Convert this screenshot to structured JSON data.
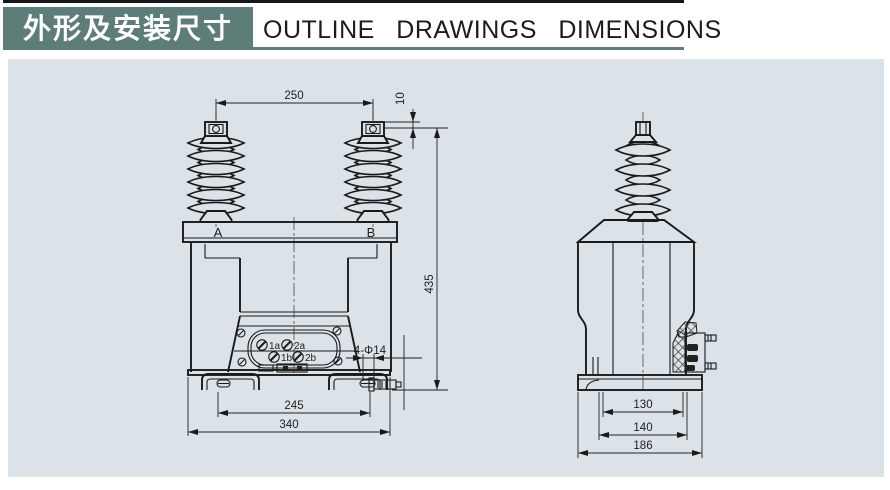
{
  "header": {
    "title_cn": "外形及安装尺寸",
    "title_en": "OUTLINE DRAWINGS DIMENSIONS"
  },
  "front_view": {
    "label_a": "A",
    "label_b": "B",
    "dims": {
      "top_span": "250",
      "cap_offset": "10",
      "height": "435",
      "hole_span": "245",
      "base_width": "340",
      "holes_label": "4-Φ14"
    },
    "terminals": {
      "t1a": "1a",
      "t2a": "2a",
      "t1b": "1b",
      "t2b": "2b"
    }
  },
  "side_view": {
    "dims": {
      "slot_span": "130",
      "foot_span": "140",
      "base_depth": "186"
    }
  },
  "colors": {
    "header_bg": "#5e7c78",
    "panel_bg": "#dbe2e8",
    "line": "#1a1a1a"
  }
}
